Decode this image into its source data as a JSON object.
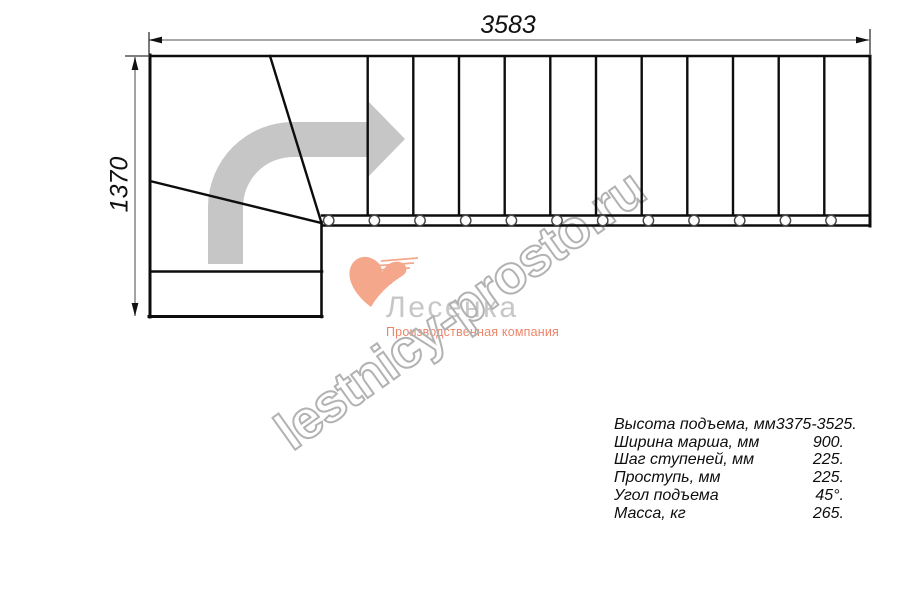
{
  "dimensions": {
    "top": "3583",
    "left": "1370"
  },
  "logo": {
    "title": "Лесенка",
    "subtitle": "Производственная компания"
  },
  "watermark_text": "lestnicy-prosto.ru",
  "specs": [
    {
      "label": "Высота подъема, мм",
      "value": "3375-3525."
    },
    {
      "label": "Ширина марша, мм",
      "value": "900."
    },
    {
      "label": "Шаг ступеней, мм",
      "value": "225."
    },
    {
      "label": "Проступь, мм",
      "value": "225."
    },
    {
      "label": "Угол подъема",
      "value": "45°."
    },
    {
      "label": "Масса, кг",
      "value": "265."
    }
  ],
  "colors": {
    "line": "#0d0d0d",
    "dim_line": "#8c8c8c",
    "arrow_gray": "#c6c6c6",
    "logo_gray": "#c7c7c7",
    "logo_salmon": "#f5a78c",
    "subtitle_salmon": "#ee8468",
    "watermark_gray": "#b2b2b2"
  }
}
